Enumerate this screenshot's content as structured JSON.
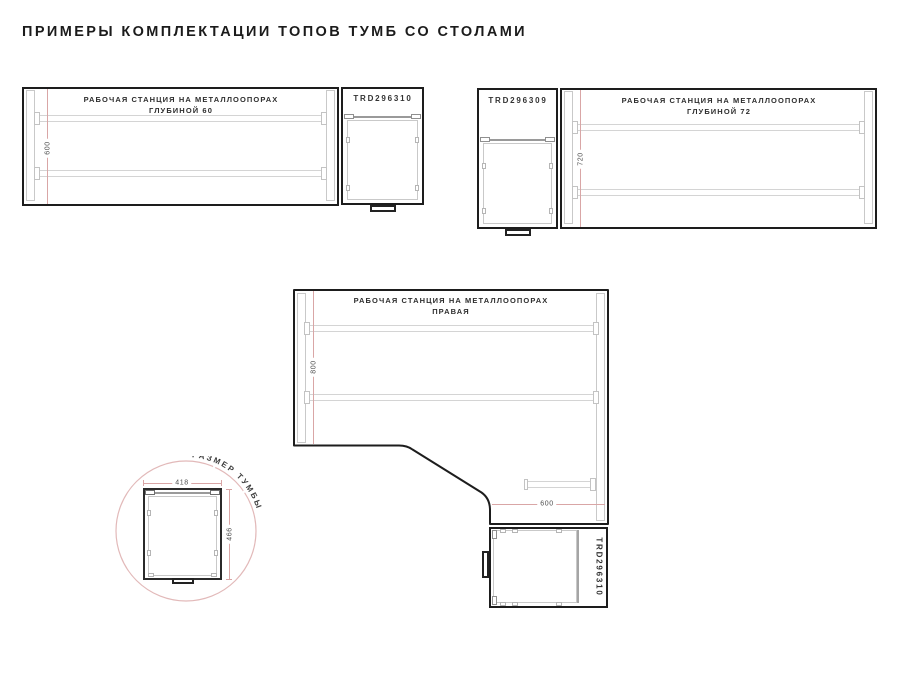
{
  "page": {
    "title": "ПРИМЕРЫ КОМПЛЕКТАЦИИ ТОПОВ ТУМБ СО СТОЛАМИ"
  },
  "colors": {
    "ink": "#1d1d1d",
    "structure_gray": "#c9c9c9",
    "dimension_red": "#d9a6a6",
    "dimension_text": "#4d4d4d",
    "circle_pink": "#e2b9b9"
  },
  "diagrams": {
    "desk60": {
      "title_line1": "РАБОЧАЯ СТАНЦИЯ НА МЕТАЛЛООПОРАХ",
      "title_line2": "ГЛУБИНОЙ 60",
      "depth_dim": "600",
      "cabinet_code": "TRD296310"
    },
    "desk72": {
      "title_line1": "РАБОЧАЯ СТАНЦИЯ НА МЕТАЛЛООПОРАХ",
      "title_line2": "ГЛУБИНОЙ 72",
      "depth_dim": "720",
      "cabinet_code": "TRD296309"
    },
    "desk_corner": {
      "title_line1": "РАБОЧАЯ СТАНЦИЯ НА МЕТАЛЛООПОРАХ",
      "title_line2": "ПРАВАЯ",
      "depth_dim": "800",
      "return_dim": "600",
      "cabinet_code": "TRD296310"
    },
    "cabinet_size": {
      "label": "РАЗМЕР ТУМБЫ",
      "width_dim": "418",
      "depth_dim": "466"
    }
  }
}
